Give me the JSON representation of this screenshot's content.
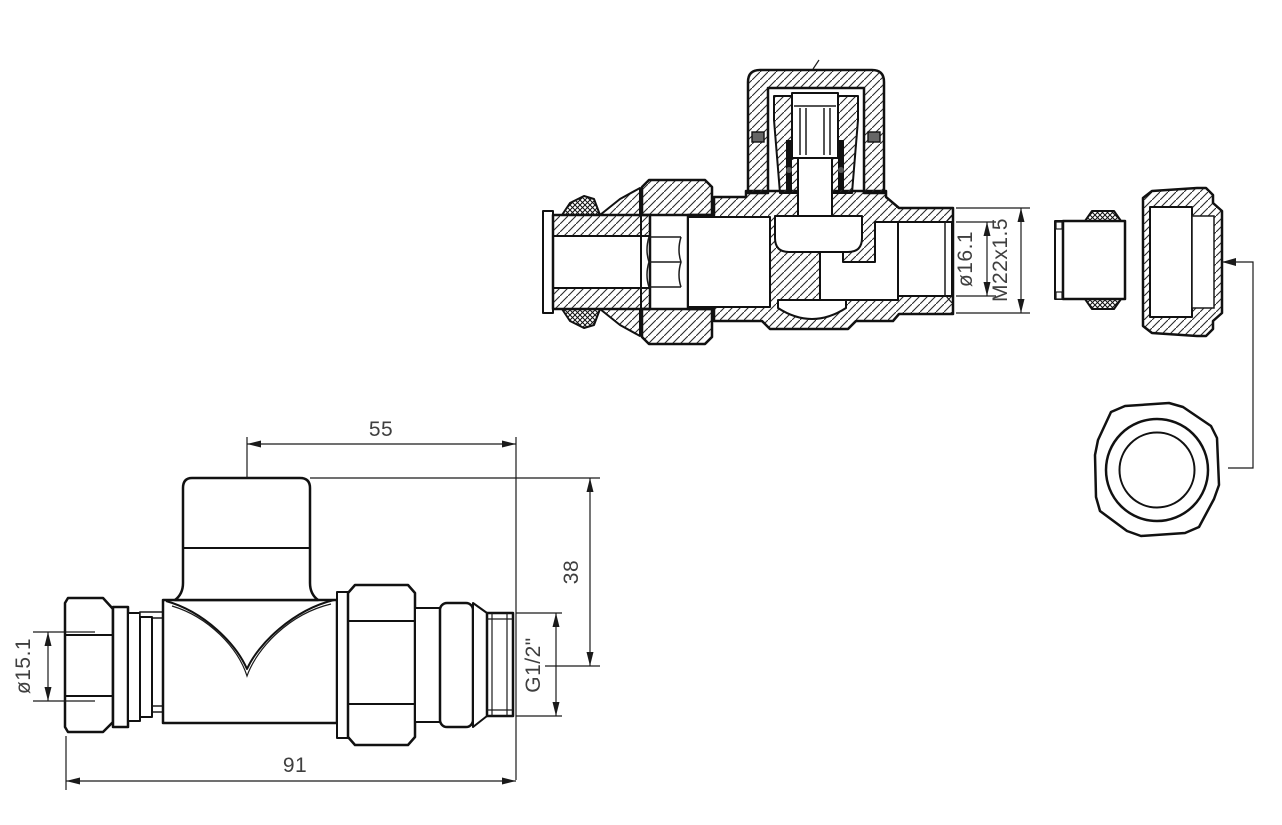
{
  "drawing": {
    "kind": "technical-drawing",
    "background": "#ffffff",
    "line_color": "#111111",
    "text_color": "#3f3f3f"
  },
  "dimensions": {
    "section_view": {
      "bore_diameter": "ø16.1",
      "union_thread": "M22x1.5"
    },
    "side_view": {
      "head_to_outlet": "55",
      "axis_height": "38",
      "overall_length": "91",
      "inlet_diameter": "ø15.1",
      "outlet_thread": "G1/2\""
    }
  }
}
